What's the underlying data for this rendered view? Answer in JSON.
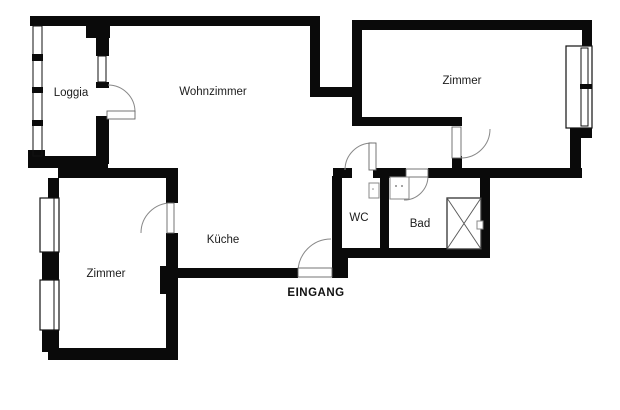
{
  "plan": {
    "type": "floor-plan",
    "language": "de",
    "rooms": [
      {
        "id": "loggia",
        "label": "Loggia"
      },
      {
        "id": "wohnzimmer",
        "label": "Wohnzimmer"
      },
      {
        "id": "zimmer-top-right",
        "label": "Zimmer"
      },
      {
        "id": "kueche",
        "label": "Küche"
      },
      {
        "id": "wc",
        "label": "WC"
      },
      {
        "id": "bad",
        "label": "Bad"
      },
      {
        "id": "zimmer-bottom-left",
        "label": "Zimmer"
      }
    ],
    "entrance_label": "EINGANG",
    "features": {
      "doors": [
        "loggia-wohnzimmer",
        "zimmer-top-right",
        "wc",
        "bad",
        "zimmer-bottom-left",
        "eingang"
      ],
      "windows": [
        "loggia-glazing",
        "loggia-inner-window",
        "zimmer-top-right-window",
        "zimmer-bottom-left-window-1",
        "zimmer-bottom-left-window-2"
      ],
      "shaft": "crossed-box"
    },
    "colors": {
      "wall": "#0a0a0a",
      "background": "#ffffff",
      "door_arc": "#888888",
      "label": "#1c1c1c"
    }
  }
}
